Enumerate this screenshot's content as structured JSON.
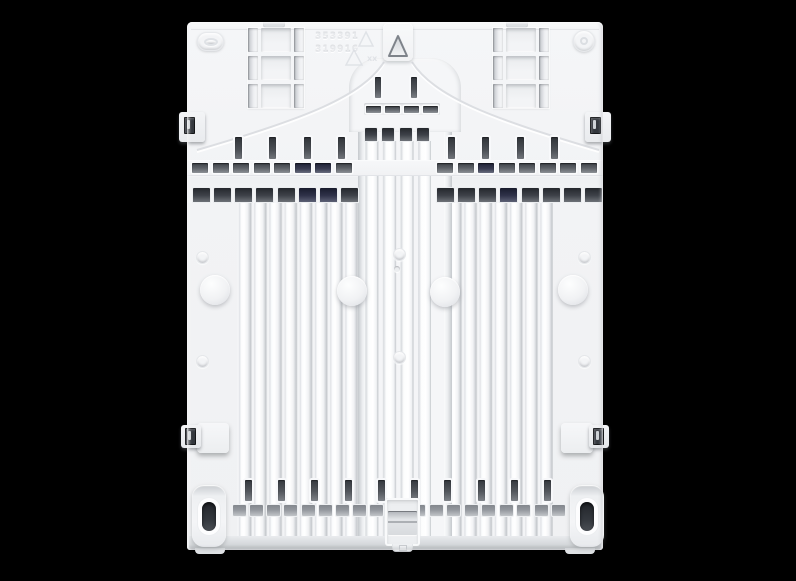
{
  "scene": {
    "description": "Product photo: rear side of a white molded plastic appliance panel with vertical ribs, vent slots, snap clips and oval feet, centered on a black background",
    "type": "product-photo"
  },
  "panel": {
    "mold_number_line1": "353391",
    "mold_number_line2": "319916",
    "recycle_code_label": "xx",
    "markings": [
      "recycling-triangle",
      "recycling-triangle",
      "molded-alignment-arrow"
    ]
  },
  "structure": {
    "ladder_cells": {
      "count": 3
    },
    "center_vertical_slots": {
      "count": 2
    },
    "center_strip_slots": {
      "count": 4
    },
    "mid_vslots_left": {
      "count": 4
    },
    "mid_vslots_right": {
      "count": 4
    },
    "vent_slots_left": {
      "count": 8
    },
    "vent_slots_right": {
      "count": 8
    },
    "rib_caps_left": {
      "count": 8
    },
    "rib_caps_right": {
      "count": 8
    },
    "channel_caps": {
      "count": 4
    },
    "bottom_vslots": {
      "count": 10
    },
    "bottom_tabs_left": {
      "count": 9
    },
    "bottom_tabs_right": {
      "count": 9
    }
  },
  "colors": {
    "bg": "#000000",
    "body": "#f2f3f5",
    "emboss": "#e7e9ec",
    "slot-dark": "#34383e",
    "slot-navy": "#1f2236",
    "tab-gray": "#94989e"
  }
}
